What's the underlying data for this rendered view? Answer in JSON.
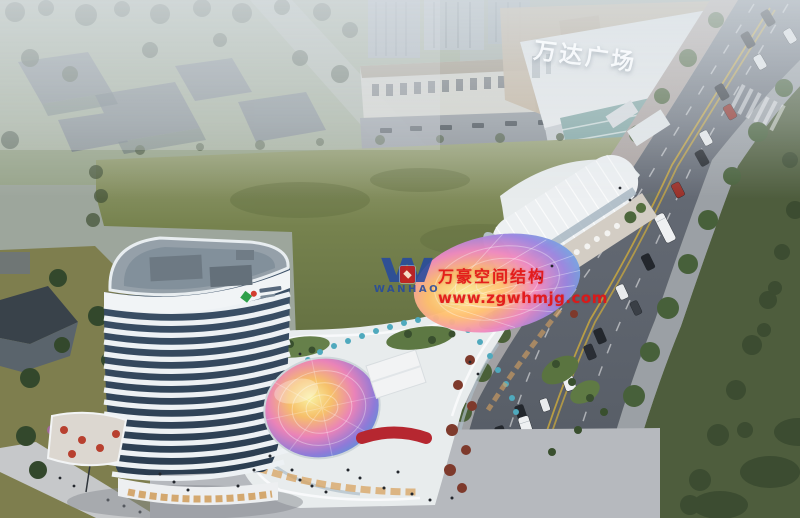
{
  "image": {
    "kind": "aerial architectural rendering",
    "subject": "mixed-use commercial plaza with high-rise tower, rainbow glass dome, iridescent canopy, mall and tree-lined arterial road",
    "width_px": 800,
    "height_px": 518
  },
  "signage": {
    "mall_sign": "万达广场"
  },
  "watermark": {
    "logo_letter": "W",
    "logo_subtext": "WANHAO",
    "line1": "万豪空间结构",
    "line2": "www.zgwhmjg.com",
    "text_color": "#e31616",
    "logo_color": "#2b4ea0",
    "badge_color": "#c4201f"
  },
  "palette": {
    "haze": "#d3dae0",
    "lawn_green": "#6d7a47",
    "road_gray": "#5c636d",
    "lane_yellow": "#c9a83e",
    "tower_white": "#eef1f4",
    "tower_glass": "#33475c",
    "dome_colors": [
      "#f9f0a0",
      "#f6c06a",
      "#ea83b8",
      "#8f7ad8",
      "#2e6fa8"
    ],
    "canopy_colors": [
      "#fff3a0",
      "#ffc070",
      "#f08ac0",
      "#9b86e0",
      "#3a86c8"
    ],
    "mall_roof_tan": "#c0ac94",
    "sign_white": "#fafcfe",
    "umbrella_red": "#b8402f",
    "umbrella_teal": "#4fa9bd"
  }
}
